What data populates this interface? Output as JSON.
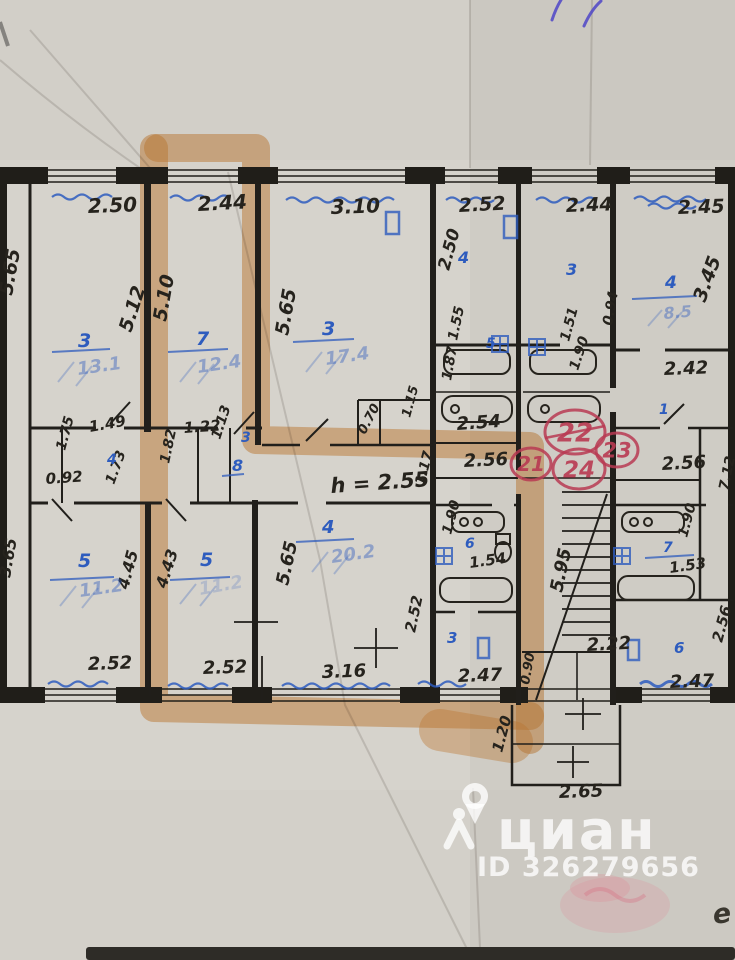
{
  "watermark": {
    "brand": "циан",
    "id_label": "ID 326279656"
  },
  "handwriting_mark": "e",
  "colors": {
    "paper": "#d6d3cc",
    "ink": "#26231d",
    "blue": "#2e5cbe",
    "orange": "#e0913f",
    "red": "#b93a52",
    "bar": "#2e2c27"
  },
  "red_circles": [
    {
      "label": "22",
      "x": 575,
      "y": 432,
      "rx": 30,
      "ry": 22,
      "size": 26,
      "strike": true
    },
    {
      "label": "23",
      "x": 617,
      "y": 450,
      "rx": 21,
      "ry": 17,
      "size": 21,
      "strike": false
    },
    {
      "label": "21",
      "x": 531,
      "y": 464,
      "rx": 20,
      "ry": 16,
      "size": 20,
      "strike": false
    },
    {
      "label": "24",
      "x": 579,
      "y": 469,
      "rx": 26,
      "ry": 20,
      "size": 23,
      "strike": false
    }
  ],
  "plan_labels": [
    {
      "t": "2.50",
      "x": 88,
      "y": 213,
      "r": -2,
      "c": "i",
      "s": 20
    },
    {
      "t": "2.44",
      "x": 198,
      "y": 211,
      "r": -3,
      "c": "i",
      "s": 20
    },
    {
      "t": "3.10",
      "x": 331,
      "y": 214,
      "r": -2,
      "c": "i",
      "s": 20
    },
    {
      "t": "2.52",
      "x": 459,
      "y": 212,
      "r": -3,
      "c": "i",
      "s": 19
    },
    {
      "t": "2.44",
      "x": 566,
      "y": 212,
      "r": -2,
      "c": "i",
      "s": 19
    },
    {
      "t": "2.45",
      "x": 678,
      "y": 214,
      "r": -2,
      "c": "i",
      "s": 19
    },
    {
      "t": "5.65",
      "x": 12,
      "y": 296,
      "r": -80,
      "c": "i",
      "s": 19
    },
    {
      "t": "5.12",
      "x": 131,
      "y": 333,
      "r": -72,
      "c": "i",
      "s": 19
    },
    {
      "t": "5.10",
      "x": 166,
      "y": 322,
      "r": -80,
      "c": "i",
      "s": 19
    },
    {
      "t": "5.65",
      "x": 288,
      "y": 336,
      "r": -80,
      "c": "i",
      "s": 19
    },
    {
      "t": "2.50",
      "x": 449,
      "y": 271,
      "r": -75,
      "c": "i",
      "s": 17
    },
    {
      "t": "3.45",
      "x": 705,
      "y": 303,
      "r": -70,
      "c": "i",
      "s": 19
    },
    {
      "t": "0.94",
      "x": 612,
      "y": 326,
      "r": -80,
      "c": "i",
      "s": 14
    },
    {
      "t": "1.55",
      "x": 457,
      "y": 341,
      "r": -78,
      "c": "i",
      "s": 14
    },
    {
      "t": "1.87",
      "x": 451,
      "y": 381,
      "r": -80,
      "c": "i",
      "s": 14
    },
    {
      "t": "1.51",
      "x": 569,
      "y": 342,
      "r": -75,
      "c": "i",
      "s": 14
    },
    {
      "t": "1.90",
      "x": 578,
      "y": 371,
      "r": -72,
      "c": "i",
      "s": 14
    },
    {
      "t": "2.42",
      "x": 664,
      "y": 375,
      "r": -2,
      "c": "i",
      "s": 18
    },
    {
      "t": "0.92",
      "x": 46,
      "y": 484,
      "r": -4,
      "c": "i",
      "s": 15
    },
    {
      "t": "1.49",
      "x": 90,
      "y": 432,
      "r": -10,
      "c": "i",
      "s": 15
    },
    {
      "t": "1.75",
      "x": 65,
      "y": 451,
      "r": -75,
      "c": "i",
      "s": 14
    },
    {
      "t": "1.73",
      "x": 114,
      "y": 485,
      "r": -70,
      "c": "i",
      "s": 14
    },
    {
      "t": "1.22",
      "x": 184,
      "y": 433,
      "r": -4,
      "c": "i",
      "s": 15
    },
    {
      "t": "1.82",
      "x": 169,
      "y": 464,
      "r": -78,
      "c": "i",
      "s": 14
    },
    {
      "t": "1.13",
      "x": 220,
      "y": 440,
      "r": -72,
      "c": "i",
      "s": 14
    },
    {
      "t": "h = 2.55",
      "x": 331,
      "y": 493,
      "r": -4,
      "c": "i",
      "s": 21,
      "n": "height-note"
    },
    {
      "t": "0.70",
      "x": 365,
      "y": 435,
      "r": -62,
      "c": "i",
      "s": 13
    },
    {
      "t": "1.15",
      "x": 410,
      "y": 418,
      "r": -75,
      "c": "i",
      "s": 13
    },
    {
      "t": "2.54",
      "x": 457,
      "y": 430,
      "r": -4,
      "c": "i",
      "s": 18
    },
    {
      "t": "2.56",
      "x": 464,
      "y": 467,
      "r": -3,
      "c": "i",
      "s": 18
    },
    {
      "t": "1.17",
      "x": 424,
      "y": 486,
      "r": -75,
      "c": "i",
      "s": 14
    },
    {
      "t": "2.56",
      "x": 662,
      "y": 470,
      "r": -3,
      "c": "i",
      "s": 18
    },
    {
      "t": "7.12",
      "x": 728,
      "y": 491,
      "r": -78,
      "c": "i",
      "s": 14
    },
    {
      "t": "1.90",
      "x": 451,
      "y": 535,
      "r": -75,
      "c": "i",
      "s": 14
    },
    {
      "t": "1.54",
      "x": 470,
      "y": 568,
      "r": -8,
      "c": "i",
      "s": 15
    },
    {
      "t": "2.52",
      "x": 415,
      "y": 633,
      "r": -78,
      "c": "i",
      "s": 15
    },
    {
      "t": "2.47",
      "x": 458,
      "y": 682,
      "r": -2,
      "c": "i",
      "s": 18
    },
    {
      "t": "5.95",
      "x": 562,
      "y": 593,
      "r": -78,
      "c": "i",
      "s": 18
    },
    {
      "t": "2.22",
      "x": 587,
      "y": 651,
      "r": -3,
      "c": "i",
      "s": 18
    },
    {
      "t": "0.90",
      "x": 529,
      "y": 685,
      "r": -80,
      "c": "i",
      "s": 13
    },
    {
      "t": "1.20",
      "x": 502,
      "y": 753,
      "r": -75,
      "c": "i",
      "s": 15
    },
    {
      "t": "2.65",
      "x": 559,
      "y": 798,
      "r": -2,
      "c": "i",
      "s": 18
    },
    {
      "t": "1.90",
      "x": 687,
      "y": 538,
      "r": -75,
      "c": "i",
      "s": 14
    },
    {
      "t": "1.53",
      "x": 670,
      "y": 573,
      "r": -8,
      "c": "i",
      "s": 15
    },
    {
      "t": "2.47",
      "x": 670,
      "y": 688,
      "r": -2,
      "c": "i",
      "s": 18
    },
    {
      "t": "2.56",
      "x": 722,
      "y": 643,
      "r": -75,
      "c": "i",
      "s": 15
    },
    {
      "t": "2.52",
      "x": 88,
      "y": 670,
      "r": -2,
      "c": "i",
      "s": 18
    },
    {
      "t": "2.52",
      "x": 203,
      "y": 674,
      "r": -2,
      "c": "i",
      "s": 18
    },
    {
      "t": "3.16",
      "x": 322,
      "y": 678,
      "r": -2,
      "c": "i",
      "s": 18
    },
    {
      "t": "4.45",
      "x": 128,
      "y": 590,
      "r": -75,
      "c": "i",
      "s": 16
    },
    {
      "t": "4.43",
      "x": 166,
      "y": 589,
      "r": -72,
      "c": "i",
      "s": 16
    },
    {
      "t": "5.65",
      "x": 288,
      "y": 586,
      "r": -78,
      "c": "i",
      "s": 18
    },
    {
      "t": "3.65",
      "x": 10,
      "y": 578,
      "r": -80,
      "c": "i",
      "s": 16
    },
    {
      "t": "3",
      "x": 78,
      "y": 347,
      "c": "b",
      "s": 19
    },
    {
      "t": "7",
      "x": 196,
      "y": 345,
      "c": "b",
      "s": 19
    },
    {
      "t": "3",
      "x": 322,
      "y": 335,
      "c": "b",
      "s": 19
    },
    {
      "t": "4",
      "x": 458,
      "y": 263,
      "c": "b",
      "s": 16
    },
    {
      "t": "3",
      "x": 566,
      "y": 275,
      "c": "b",
      "s": 16
    },
    {
      "t": "4",
      "x": 665,
      "y": 288,
      "c": "b",
      "s": 17
    },
    {
      "t": "4",
      "x": 107,
      "y": 464,
      "c": "b",
      "s": 14
    },
    {
      "t": "3",
      "x": 241,
      "y": 442,
      "c": "b",
      "s": 14
    },
    {
      "t": "8",
      "x": 232,
      "y": 471,
      "c": "b",
      "s": 16
    },
    {
      "t": "5",
      "x": 486,
      "y": 348,
      "c": "b",
      "s": 14
    },
    {
      "t": "6",
      "x": 465,
      "y": 548,
      "c": "b",
      "s": 14
    },
    {
      "t": "3",
      "x": 447,
      "y": 643,
      "c": "b",
      "s": 15
    },
    {
      "t": "6",
      "x": 674,
      "y": 653,
      "c": "b",
      "s": 15
    },
    {
      "t": "7",
      "x": 663,
      "y": 552,
      "c": "b",
      "s": 14
    },
    {
      "t": "1",
      "x": 659,
      "y": 414,
      "c": "b",
      "s": 14
    },
    {
      "t": "5",
      "x": 78,
      "y": 567,
      "c": "b",
      "s": 19
    },
    {
      "t": "5",
      "x": 200,
      "y": 566,
      "c": "b",
      "s": 19
    },
    {
      "t": "4",
      "x": 322,
      "y": 533,
      "c": "b",
      "s": 18
    },
    {
      "t": "13.1",
      "x": 78,
      "y": 375,
      "r": -8,
      "c": "bf",
      "s": 18
    },
    {
      "t": "12.4",
      "x": 198,
      "y": 373,
      "r": -8,
      "c": "bf",
      "s": 18
    },
    {
      "t": "17.4",
      "x": 326,
      "y": 365,
      "r": -8,
      "c": "bf",
      "s": 18
    },
    {
      "t": "8.5",
      "x": 664,
      "y": 319,
      "r": -5,
      "c": "bf",
      "s": 16
    },
    {
      "t": "11.2",
      "x": 80,
      "y": 597,
      "r": -8,
      "c": "bf",
      "s": 18
    },
    {
      "t": "20.2",
      "x": 332,
      "y": 563,
      "r": -8,
      "c": "bf",
      "s": 18
    },
    {
      "t": "11.2",
      "x": 200,
      "y": 595,
      "r": -10,
      "c": "bx",
      "s": 18
    }
  ]
}
